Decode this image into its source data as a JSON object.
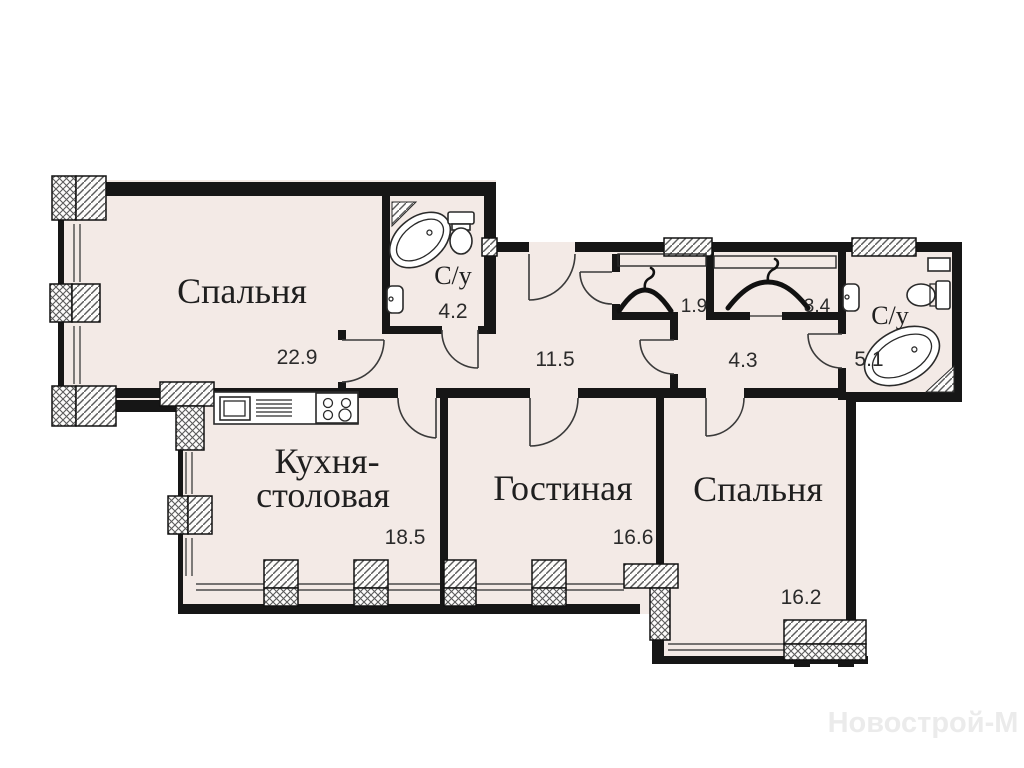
{
  "plan": {
    "watermark": "Новострой-М",
    "colors": {
      "floor": "#f3eae6",
      "wall": "#161616",
      "watermark": "#ebebeb"
    },
    "rooms": {
      "bedroom1": {
        "name": "Спальня",
        "area": "22.9"
      },
      "bathroom1": {
        "name": "С/у",
        "area": "4.2"
      },
      "hallway": {
        "area": "11.5"
      },
      "wardrobe1": {
        "area": "1.9"
      },
      "wardrobe2": {
        "area": "3.4"
      },
      "hall": {
        "area": "4.3"
      },
      "bathroom2": {
        "name": "С/у",
        "area": "5.1"
      },
      "kitchen": {
        "name_line1": "Кухня-",
        "name_line2": "столовая",
        "area": "18.5"
      },
      "living": {
        "name": "Гостиная",
        "area": "16.6"
      },
      "bedroom2": {
        "name": "Спальня",
        "area": "16.2"
      }
    }
  }
}
